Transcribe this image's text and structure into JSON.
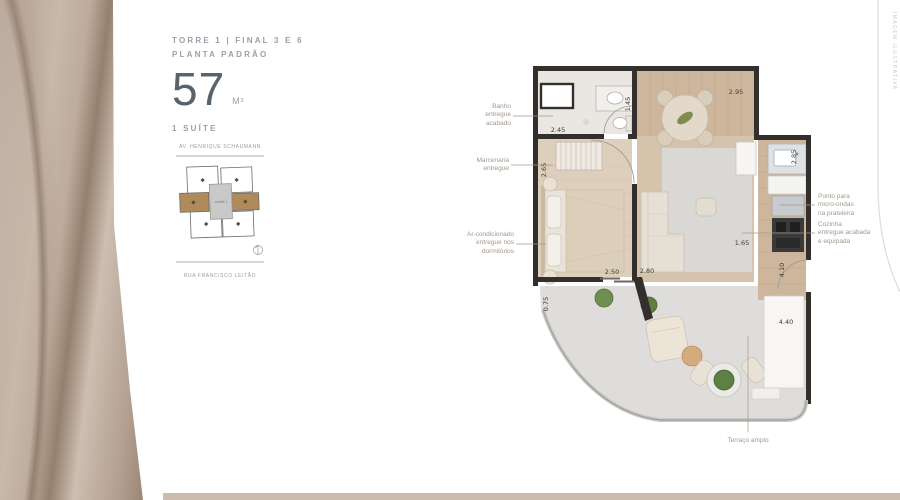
{
  "header": {
    "tower_line": "TORRE 1 | FINAL 3 E 6",
    "plan_line": "PLANTA PADRÃO",
    "area_value": "57",
    "area_unit": "M²",
    "suites_line": "1 SUÍTE"
  },
  "keyplan": {
    "street_top": "AV. HENRIQUE SCHAUMANN",
    "street_bottom": "RUA FRANCISCO LEITÃO",
    "core_label": "TORRE 1"
  },
  "floorplan": {
    "dims": {
      "bath_width": "2.45",
      "closet_height": "2.65",
      "dining_left": "1.45",
      "dining_top": "2.95",
      "kitchen_right": "2.85",
      "kitchen_width": "1.65",
      "bedroom_width": "2.50",
      "living_width": "2.80",
      "entry_side": "0.75",
      "kitchen_length": "4.10",
      "terrace_width": "4.40"
    },
    "annotations": {
      "bath": "Banho\nentregue\nacabado",
      "joinery": "Marcenaria\nentregue",
      "ac": "Ar-condicionado\nentregue nos\ndormitórios",
      "microwave": "Ponto para\nmicro-ondas\nna prateleira",
      "kitchen": "Cozinha\nentregue acabada\ne equipada",
      "terrace": "Terraço amplo"
    }
  },
  "right_margin": {
    "vertical_label": "IMAGEM ILUSTRATIVA"
  },
  "colors": {
    "accent_tan": "#b08a58",
    "wall": "#332f2c",
    "wood_floor": "#cdb69c",
    "terrace_floor": "#dedddb",
    "beige_bar": "#cbbcae"
  }
}
